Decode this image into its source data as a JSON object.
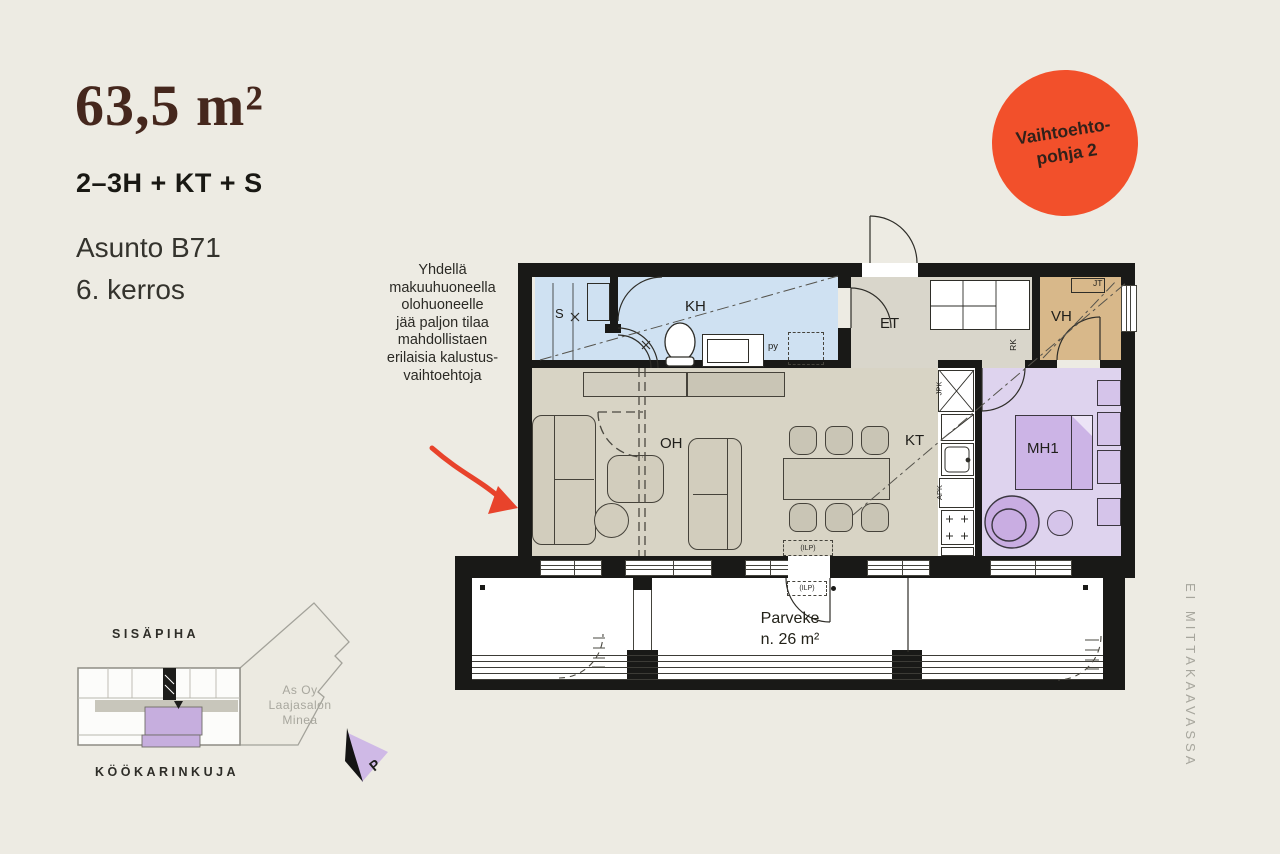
{
  "header": {
    "area": "63,5 m²",
    "room_config": "2–3H + KT + S",
    "apartment": "Asunto B71",
    "floor": "6. kerros"
  },
  "badge": {
    "line1": "Vaihtoehto-",
    "line2": "pohja 2",
    "color": "#F2502B"
  },
  "annotation": {
    "lines": [
      "Yhdellä",
      "makuuhuoneella",
      "olohuoneelle",
      "jää paljon tilaa",
      "mahdollistaen",
      "erilaisia kalustus-",
      "vaihtoehtoja"
    ]
  },
  "floorplan": {
    "rooms": {
      "sauna": "S",
      "bathroom": "KH",
      "hall": "ET",
      "closet": "VH",
      "living": "OH",
      "kitchen": "KT",
      "bedroom": "MH1"
    },
    "labels": {
      "jt": "JT",
      "rk": "RK",
      "py": "py",
      "jpk": "JPK",
      "apk": "APK",
      "ilp": "(ILP)"
    },
    "balcony": {
      "name": "Parveke",
      "area": "n. 26 m²"
    },
    "colors": {
      "bathroom_blue": "#CFE1F2",
      "hall_grey": "#D9D6CB",
      "closet_tan": "#D8B88A",
      "living_greige": "#D8D4C5",
      "bedroom_purple": "#DED3EE",
      "wall_black": "#191917"
    }
  },
  "siteplan": {
    "courtyard": "SISÄPIHA",
    "street": "KÖÖKARINKUJA",
    "company": [
      "As Oy",
      "Laajasalon",
      "Minea"
    ],
    "north": "P",
    "unit_highlight": "#C6AEDE"
  },
  "footnote": {
    "scale_note": "EI MITTAKAAVASSA"
  },
  "accents": {
    "badge_orange": "#F2502B",
    "arrow_red": "#E8432B"
  }
}
